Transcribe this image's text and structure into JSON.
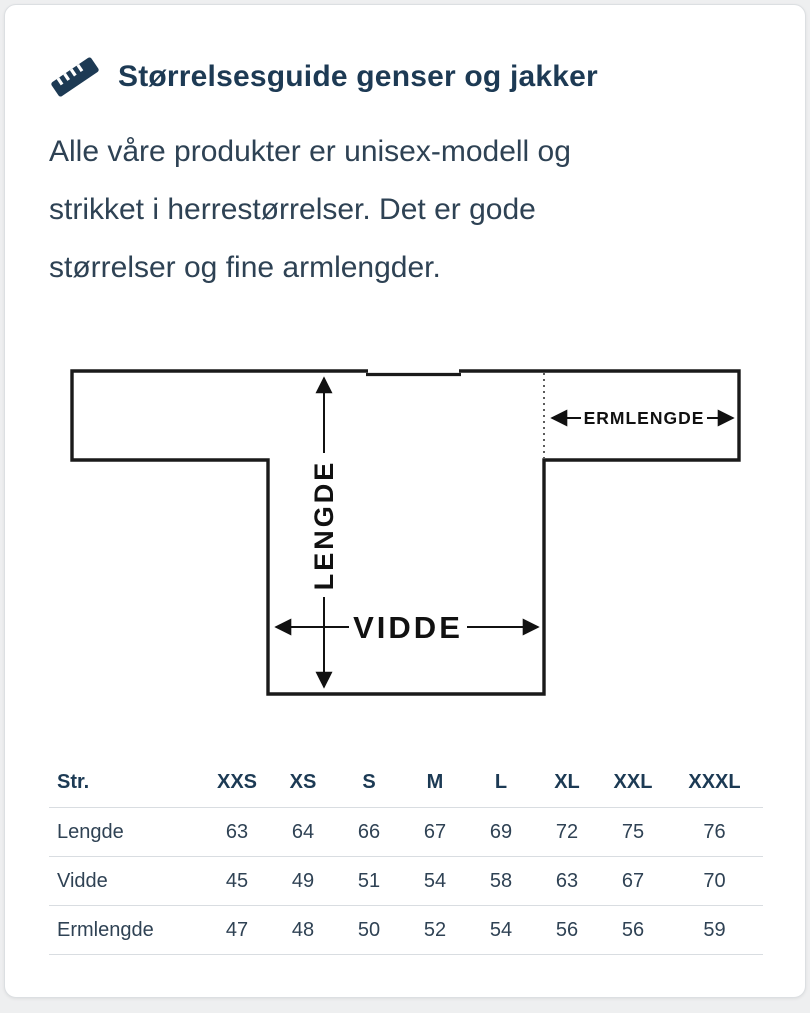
{
  "header": {
    "icon": "ruler-icon",
    "title": "Størrelsesguide genser og jakker"
  },
  "intro_lines": [
    "Alle våre produkter er unisex-modell og",
    "strikket i herrestørrelser. Det er gode",
    "størrelser og fine armlengder."
  ],
  "diagram": {
    "labels": {
      "length": "LENGDE",
      "width": "VIDDE",
      "sleeve": "ERMLENGDE"
    }
  },
  "size_table": {
    "columns": [
      "Str.",
      "XXS",
      "XS",
      "S",
      "M",
      "L",
      "XL",
      "XXL",
      "XXXL"
    ],
    "rows": [
      {
        "label": "Lengde",
        "values": [
          "63",
          "64",
          "66",
          "67",
          "69",
          "72",
          "75",
          "76"
        ]
      },
      {
        "label": "Vidde",
        "values": [
          "45",
          "49",
          "51",
          "54",
          "58",
          "63",
          "67",
          "70"
        ]
      },
      {
        "label": "Ermlengde",
        "values": [
          "47",
          "48",
          "50",
          "52",
          "54",
          "56",
          "56",
          "59"
        ]
      }
    ]
  },
  "colors": {
    "accent_navy": "#1d3a54",
    "body_text": "#2e4254",
    "diagram_line": "#111111",
    "table_separator": "#d9dde1",
    "page_background": "#eeeff0",
    "card_background": "#ffffff"
  }
}
